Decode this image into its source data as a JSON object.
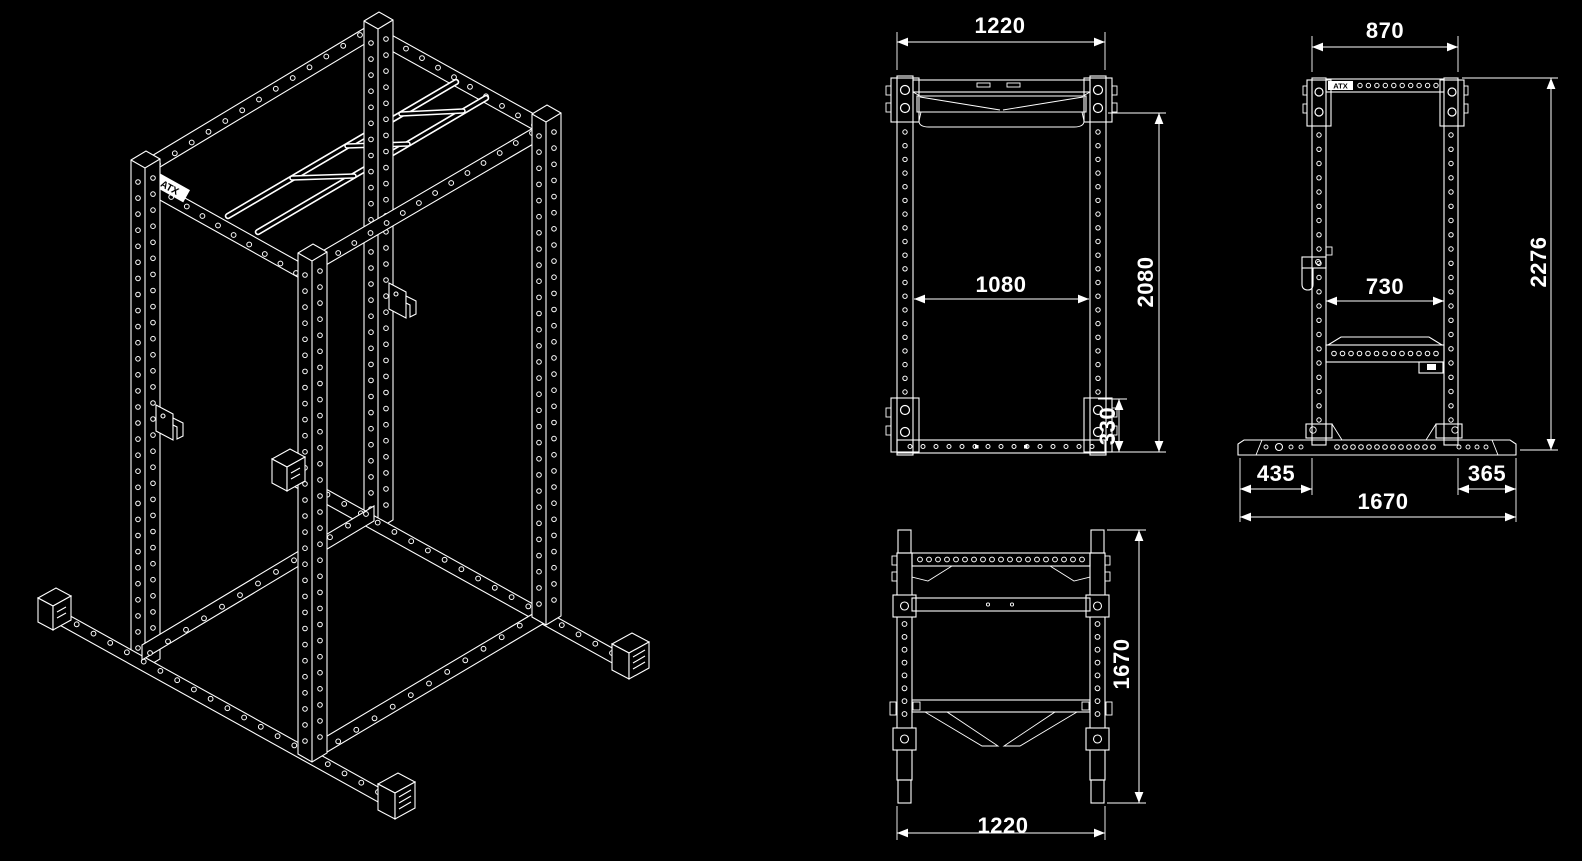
{
  "colors": {
    "background": "#000000",
    "line": "#ffffff"
  },
  "brand": {
    "logo_text": "ATX"
  },
  "views": {
    "isometric": {
      "description": "isometric wireframe of power rack"
    },
    "front": {
      "dims": {
        "outer_width": "1220",
        "inner_width": "1080",
        "height": "2080",
        "base_height": "330"
      }
    },
    "side": {
      "dims": {
        "top_width": "870",
        "inner_depth": "730",
        "total_height": "2276",
        "front_overhang": "435",
        "rear_overhang": "365",
        "total_depth": "1670"
      }
    },
    "top": {
      "dims": {
        "depth": "1670",
        "width": "1220"
      }
    }
  }
}
